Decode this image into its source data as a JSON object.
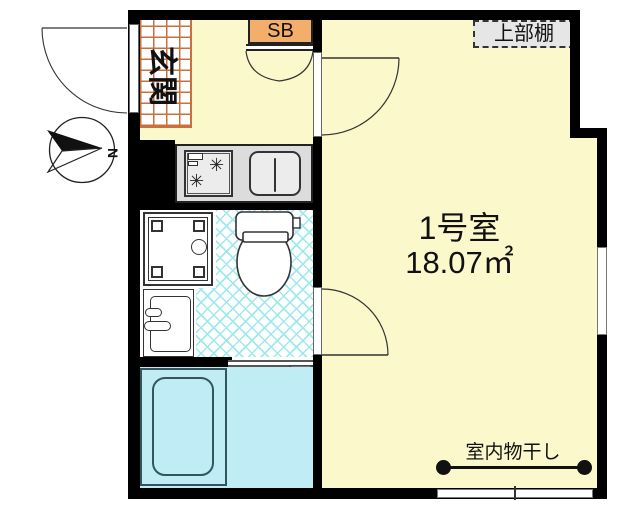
{
  "plan": {
    "compass": {
      "north_label": "N"
    },
    "entrance": {
      "label": "玄関"
    },
    "shoe_box": {
      "label": "SB"
    },
    "upper_shelf": {
      "label": "上部棚"
    },
    "main_room": {
      "name": "1号室",
      "area": "18.07㎡"
    },
    "laundry": {
      "label": "室内物干し"
    }
  },
  "colors": {
    "floor_yellow": "#FBF8CC",
    "shoebox_orange": "#F4AE6B",
    "tile_grid_orange": "#C9713D",
    "bath_cyan": "#BFECF5",
    "hatch_cyan": "#9DE9EC",
    "counter_gray": "#DCDCDC",
    "wall_black": "#000000"
  }
}
